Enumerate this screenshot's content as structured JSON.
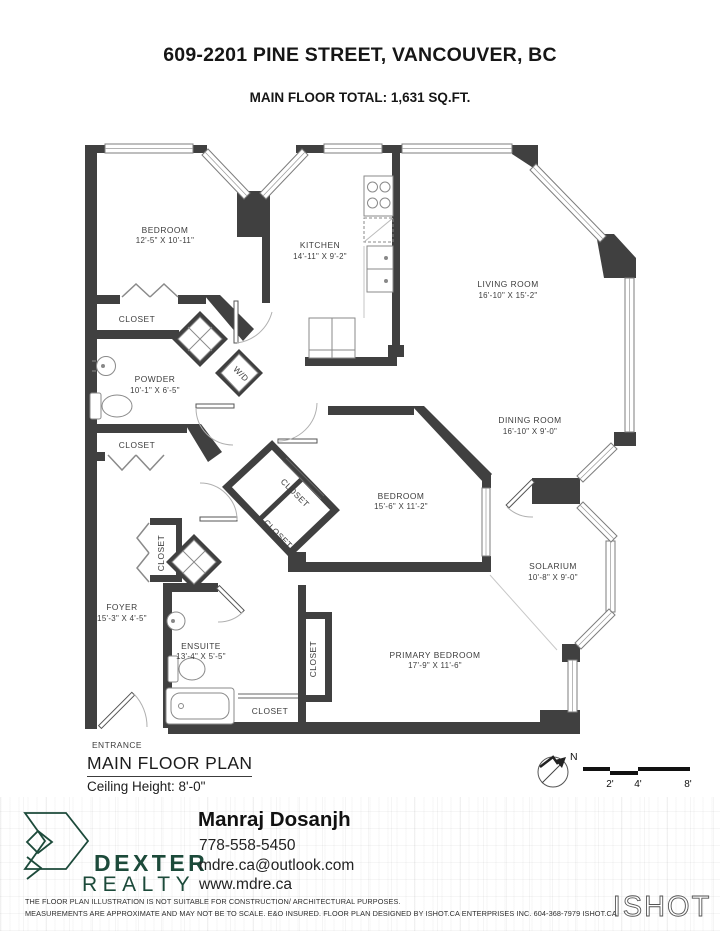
{
  "header": {
    "title": "609-2201 PINE STREET, VANCOUVER, BC",
    "subtitle": "MAIN FLOOR TOTAL: 1,631 SQ.FT."
  },
  "plan": {
    "rooms": [
      {
        "name": "BEDROOM",
        "dims": "12'-5\" X 10'-11\""
      },
      {
        "name": "KITCHEN",
        "dims": "14'-11\" X 9'-2\""
      },
      {
        "name": "LIVING ROOM",
        "dims": "16'-10\" X 15'-2\""
      },
      {
        "name": "DINING ROOM",
        "dims": "16'-10\" X 9'-0\""
      },
      {
        "name": "BEDROOM",
        "dims": "15'-6\" X 11'-2\""
      },
      {
        "name": "SOLARIUM",
        "dims": "10'-8\" X 9'-0\""
      },
      {
        "name": "PRIMARY BEDROOM",
        "dims": "17'-9\" X 11'-6\""
      },
      {
        "name": "POWDER",
        "dims": "10'-1\" X 6'-5\""
      },
      {
        "name": "ENSUITE",
        "dims": "13'-4\" X 5'-5\""
      },
      {
        "name": "FOYER",
        "dims": "15'-3\" X 4'-5\""
      }
    ],
    "labels": {
      "closet": "CLOSET",
      "wd": "W/D",
      "entrance": "ENTRANCE"
    }
  },
  "footer_plan": {
    "plan_name": "MAIN FLOOR PLAN",
    "ceiling": "Ceiling Height: 8'-0\"",
    "north": "N",
    "scale_ticks": [
      "2'",
      "4'",
      "8'"
    ]
  },
  "brand": {
    "name_line1": "DEXTER",
    "name_line2": "REALTY",
    "agent_name": "Manraj Dosanjh",
    "agent_phone": "778-558-5450",
    "agent_email": "mdre.ca@outlook.com",
    "agent_web": "www.mdre.ca"
  },
  "disclaimer": {
    "line1": "THE FLOOR PLAN ILLUSTRATION IS NOT SUITABLE FOR CONSTRUCTION/ ARCHITECTURAL PURPOSES.",
    "line2": "MEASUREMENTS ARE APPROXIMATE AND MAY NOT BE TO SCALE. E&O INSURED. FLOOR PLAN DESIGNED BY ISHOT.CA ENTERPRISES INC. 604-368-7979  ISHOT.CA",
    "logo": "ISHOT"
  },
  "colors": {
    "wall": "#404040",
    "brand_green": "#1c4a3a"
  }
}
